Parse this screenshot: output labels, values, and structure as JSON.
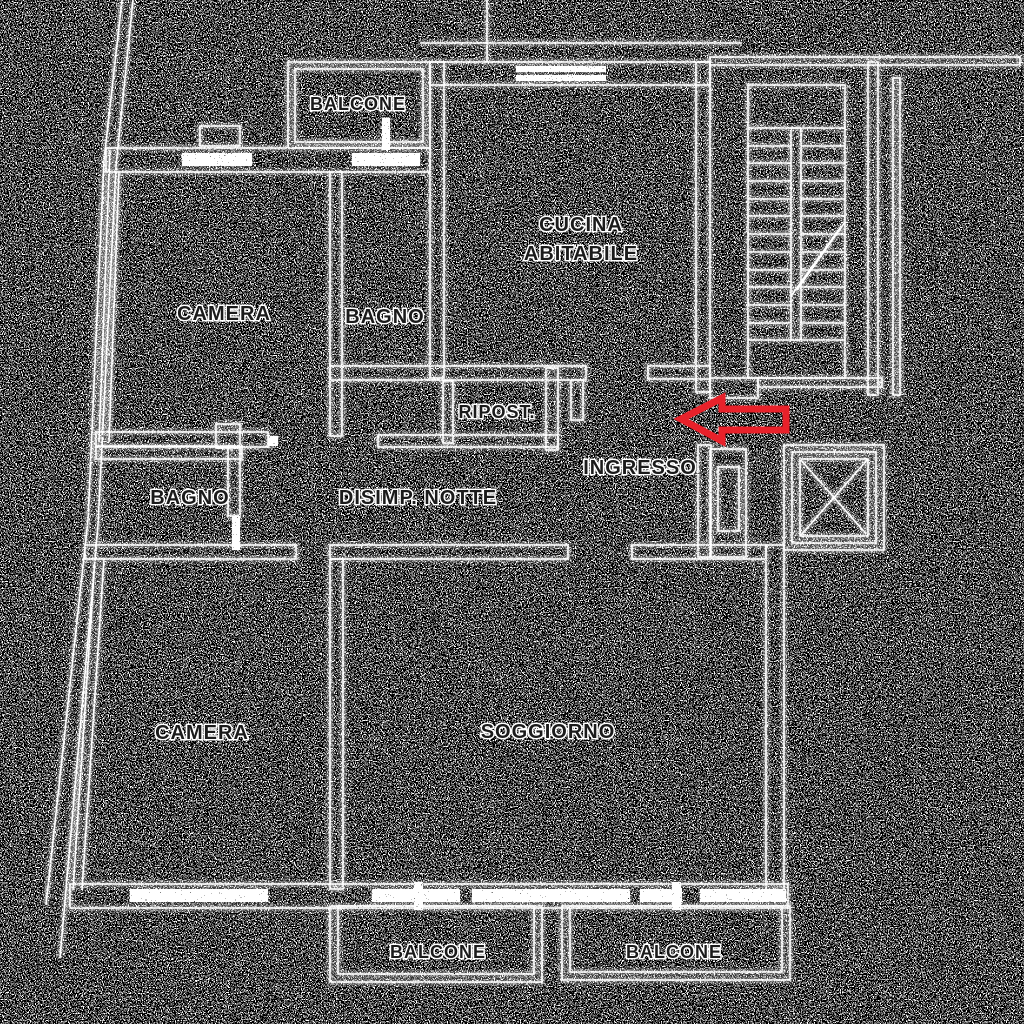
{
  "image": {
    "description": "Noisy edge-detected apartment floor plan, white line work on black background with salt-and-pepper noise and a red arrow marking the entrance",
    "palette": {
      "background": "#000000",
      "lines": "#ffffff",
      "label_fill": "#1b1b1b",
      "label_outline": "#ffffff",
      "arrow": "#e8212a"
    }
  },
  "labels": {
    "balcone_top": "BALCONE",
    "cucina_line1": "CUCINA",
    "cucina_line2": "ABITABILE",
    "camera_top": "CAMERA",
    "bagno_top": "BAGNO",
    "ripost": "RIPOST.",
    "ingresso": "INGRESSO",
    "bagno_lower": "BAGNO",
    "disimp_notte": "DISIMP. NOTTE",
    "camera_bottom": "CAMERA",
    "soggiorno": "SOGGIORNO",
    "balcone_bottom_left": "BALCONE",
    "balcone_bottom_right": "BALCONE"
  }
}
